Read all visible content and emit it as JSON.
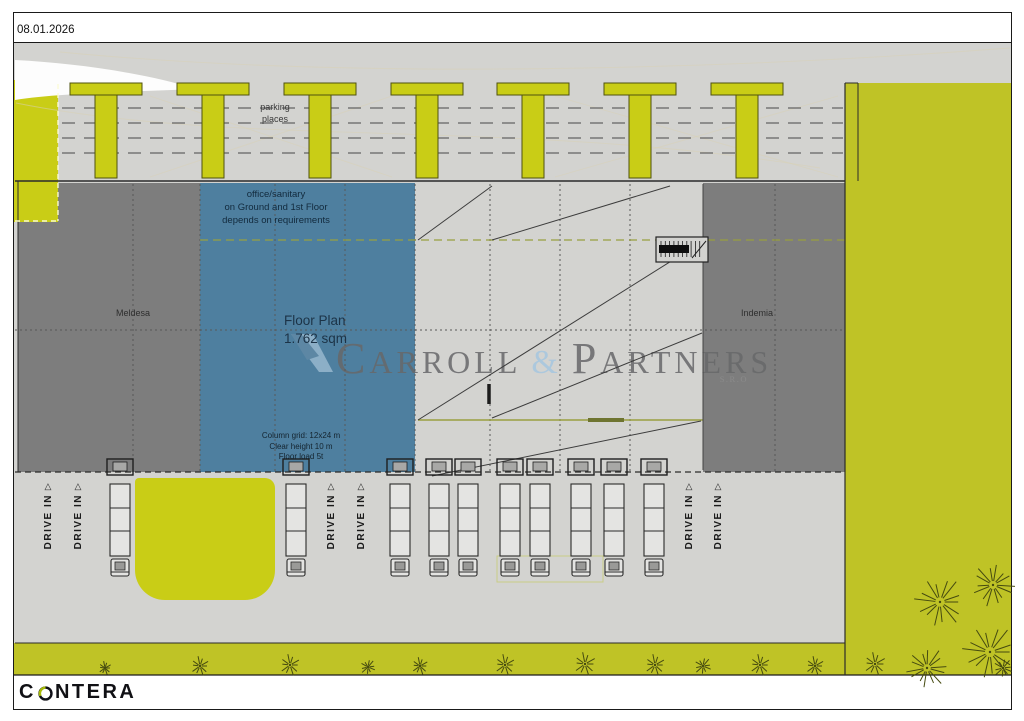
{
  "frame": {
    "date": "08.01.2026"
  },
  "labels": {
    "parking_l1": "parking",
    "parking_l2": "places",
    "drive_in": "DRIVE IN",
    "meldesa": "Meldesa",
    "indemia": "Indemia"
  },
  "office_note": {
    "l1": "office/sanitary",
    "l2": "on Ground and 1st Floor",
    "l3": "depends on requirements"
  },
  "floor_plan": {
    "title": "Floor Plan",
    "area": "1.762 sqm"
  },
  "specs": {
    "l1": "Column grid: 12x24 m",
    "l2": "Clear height 10 m",
    "l3": "Floor load 5t"
  },
  "watermark": {
    "c": "C",
    "arroll": "ARROLL",
    "amp": "&",
    "p": "P",
    "artners": "ARTNERS",
    "sro": "S.R.O"
  },
  "footer_logo": {
    "prefix": "C",
    "suffix": "NTERA",
    "name": "CONTERA"
  },
  "colors": {
    "pavement": "#d3d3d0",
    "section-gray": "#7d7d7d",
    "office-blue": "#4e7f9f",
    "greenery": "#bfc326",
    "island-yellow": "#c9cd16",
    "olive-line": "#99a040",
    "watermark-gray": "#67686a",
    "watermark-blue": "#a6c7e0",
    "logo-green": "#a8bc08"
  }
}
